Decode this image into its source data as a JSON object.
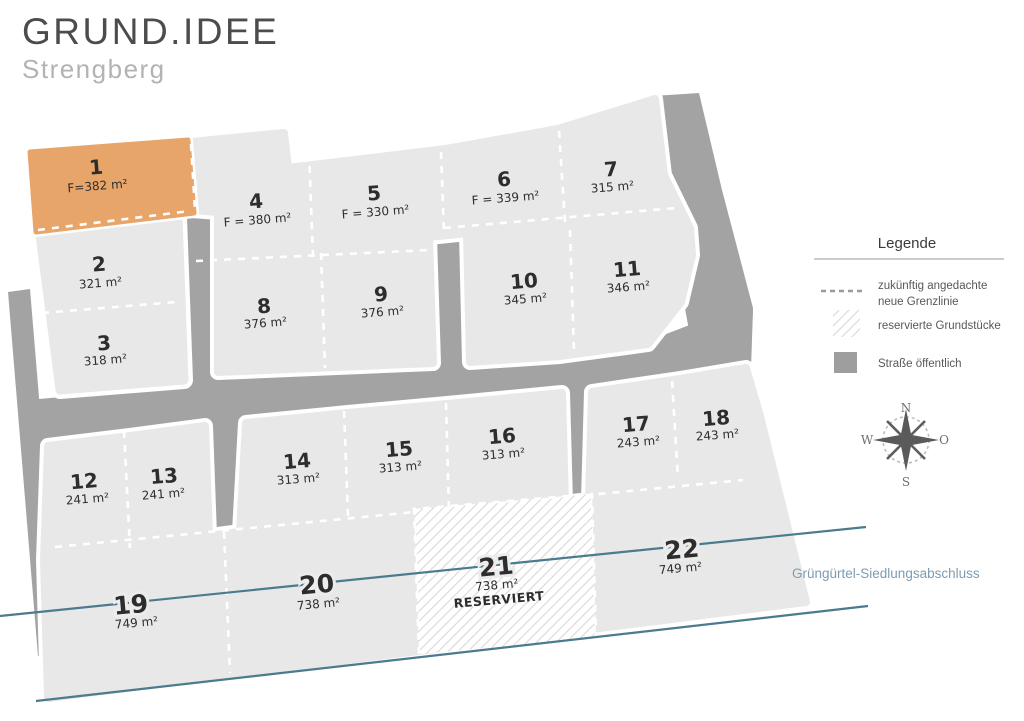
{
  "header": {
    "title": "GRUND.IDEE",
    "subtitle": "Strengberg"
  },
  "map": {
    "greenbelt_label": "Grüngürtel-Siedlungsabschluss",
    "colors": {
      "highlight": "#e8a569",
      "plot": "#e8e8e8",
      "road": "#a3a3a3",
      "boundary_line": "#4a7b8e"
    },
    "plots": [
      {
        "number": "1",
        "area": "F=382 m²",
        "highlighted": true
      },
      {
        "number": "2",
        "area": "321 m²"
      },
      {
        "number": "3",
        "area": "318 m²"
      },
      {
        "number": "4",
        "area": "F = 380 m²"
      },
      {
        "number": "5",
        "area": "F = 330 m²"
      },
      {
        "number": "6",
        "area": "F = 339 m²"
      },
      {
        "number": "7",
        "area": "315 m²"
      },
      {
        "number": "8",
        "area": "376 m²"
      },
      {
        "number": "9",
        "area": "376 m²"
      },
      {
        "number": "10",
        "area": "345 m²"
      },
      {
        "number": "11",
        "area": "346 m²"
      },
      {
        "number": "12",
        "area": "241 m²"
      },
      {
        "number": "13",
        "area": "241 m²"
      },
      {
        "number": "14",
        "area": "313 m²"
      },
      {
        "number": "15",
        "area": "313 m²"
      },
      {
        "number": "16",
        "area": "313 m²"
      },
      {
        "number": "17",
        "area": "243 m²"
      },
      {
        "number": "18",
        "area": "243 m²"
      },
      {
        "number": "19",
        "area": "749 m²"
      },
      {
        "number": "20",
        "area": "738 m²"
      },
      {
        "number": "21",
        "area": "738 m²",
        "status": "RESERVIERT"
      },
      {
        "number": "22",
        "area": "749 m²"
      }
    ]
  },
  "legend": {
    "title": "Legende",
    "items": [
      {
        "symbol": "dashed-line",
        "label_line1": "zukünftig angedachte",
        "label_line2": "neue Grenzlinie"
      },
      {
        "symbol": "hatched-square",
        "label": "reservierte Grundstücke"
      },
      {
        "symbol": "gray-square",
        "label": "Straße öffentlich"
      }
    ]
  },
  "compass": {
    "north": "N",
    "east": "O",
    "south": "S",
    "west": "W"
  }
}
